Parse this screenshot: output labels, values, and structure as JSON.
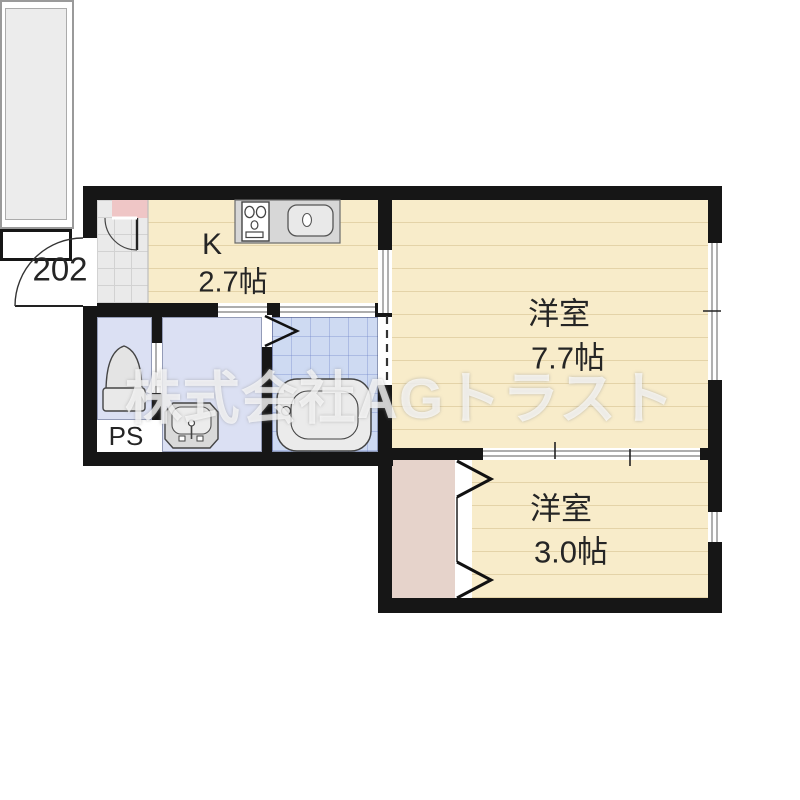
{
  "watermark": "株式会社AGトラスト",
  "entrance": {
    "unit_number": "202"
  },
  "rooms": {
    "kitchen": {
      "name": "K",
      "size": "2.7帖"
    },
    "western_room_1": {
      "name": "洋室",
      "size": "7.7帖"
    },
    "western_room_2": {
      "name": "洋室",
      "size": "3.0帖"
    },
    "pipe_space": {
      "label": "PS"
    }
  },
  "fixtures": {
    "toilet": "toilet",
    "washbasin": "washbasin",
    "bathtub": "bathtub",
    "stove": "two-burner-stove",
    "sink": "kitchen-sink",
    "entry_door": "outward-swing-door",
    "interior_door": "swing-door",
    "bath_door": "folding-door",
    "closet_door": "folding-door",
    "balcony": "balcony"
  },
  "colors": {
    "wall": "#161616",
    "room_cream": "#f8ecca",
    "wet_area_blue": "#dbe0f3",
    "bath_tile_blue": "#cedaf2",
    "entry_tile_gray": "#eaeaea",
    "entry_mat_pink": "#efc6c6",
    "closet_pink": "#e6d3cb",
    "balcony_gray": "#ececec",
    "watermark_white": "#ffffff"
  }
}
